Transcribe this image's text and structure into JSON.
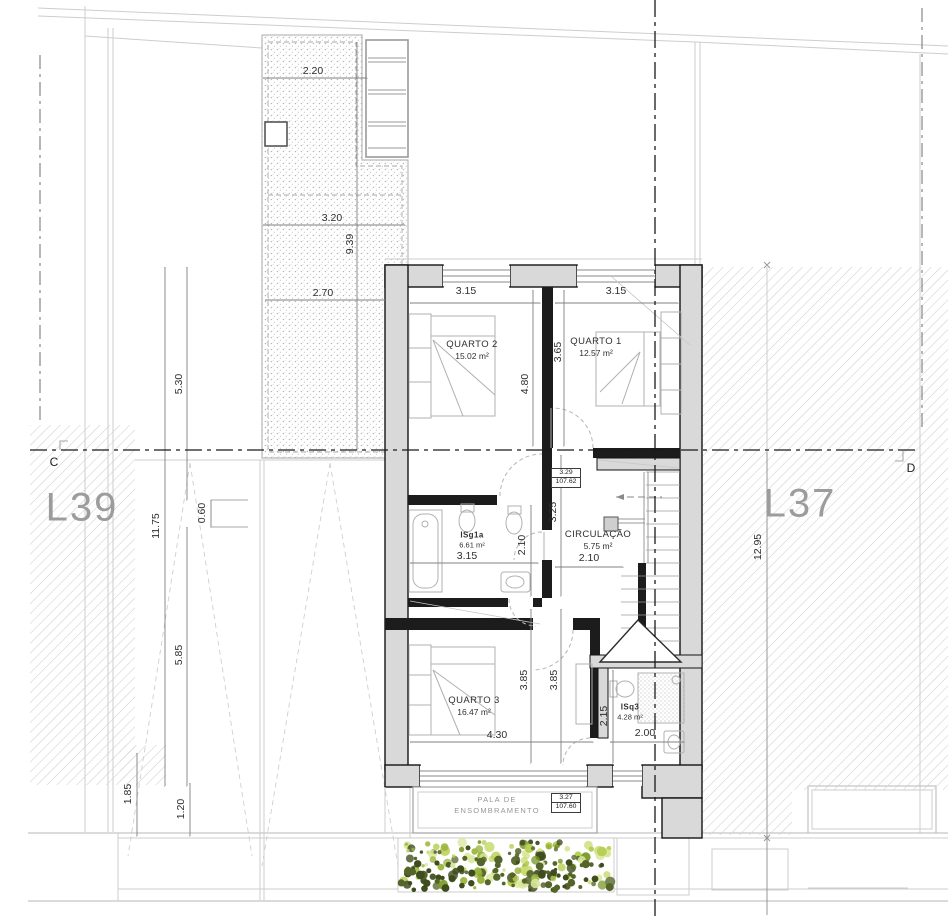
{
  "title": "Floor plan – upper level, lots L37/L39",
  "colors": {
    "wall_fill": "#d9d9d9",
    "wall_stroke": "#141414",
    "hatch_line": "#cfcfcf",
    "dim_text": "#2e2e2e",
    "lot_text": "#9c9c9c",
    "veg_greens": [
      "#b6cf53",
      "#c8dc72",
      "#9ab43a",
      "#7e9a2e",
      "#55652a",
      "#3f4d1e",
      "#d9e79a"
    ]
  },
  "lots": {
    "left": {
      "label": "L39"
    },
    "right": {
      "label": "L37"
    }
  },
  "section": {
    "left": {
      "label": "C"
    },
    "right": {
      "label": "D"
    }
  },
  "pala": {
    "line1": "PALA DE",
    "line2": "ENSOMBRAMENTO"
  },
  "rooms": [
    {
      "name": "QUARTO 2",
      "area": "15.02 m²",
      "x": 472,
      "y": 350,
      "small": false
    },
    {
      "name": "QUARTO 1",
      "area": "12.57 m²",
      "x": 596,
      "y": 347,
      "small": false
    },
    {
      "name": "ISg1a",
      "area": "6.61 m²",
      "x": 472,
      "y": 540,
      "small": true
    },
    {
      "name": "CIRCULAÇÃO",
      "area": "5.75 m²",
      "x": 598,
      "y": 540,
      "small": false
    },
    {
      "name": "QUARTO 3",
      "area": "16.47 m²",
      "x": 474,
      "y": 706,
      "small": false
    },
    {
      "name": "ISq3",
      "area": "4.28 m²",
      "x": 630,
      "y": 712,
      "small": true
    }
  ],
  "levels": [
    {
      "value": "3.29",
      "elevation": "107.62",
      "x": 551,
      "y": 468
    },
    {
      "value": "3.27",
      "elevation": "107.60",
      "x": 551,
      "y": 793
    }
  ],
  "dimensions": [
    {
      "text": "2.20",
      "x": 313,
      "y": 71,
      "rot": 0
    },
    {
      "text": "3.20",
      "x": 332,
      "y": 218,
      "rot": 0
    },
    {
      "text": "2.70",
      "x": 323,
      "y": 293,
      "rot": 0
    },
    {
      "text": "9.39",
      "x": 350,
      "y": 244,
      "rot": -90
    },
    {
      "text": "5.30",
      "x": 179,
      "y": 384,
      "rot": -90
    },
    {
      "text": "0.60",
      "x": 202,
      "y": 513,
      "rot": -90
    },
    {
      "text": "11.75",
      "x": 156,
      "y": 526,
      "rot": -90
    },
    {
      "text": "5.85",
      "x": 179,
      "y": 655,
      "rot": -90
    },
    {
      "text": "1.85",
      "x": 128,
      "y": 794,
      "rot": -90
    },
    {
      "text": "1.20",
      "x": 181,
      "y": 809,
      "rot": -90
    },
    {
      "text": "3.15",
      "x": 466,
      "y": 291,
      "rot": 0
    },
    {
      "text": "3.15",
      "x": 616,
      "y": 291,
      "rot": 0
    },
    {
      "text": "4.80",
      "x": 525,
      "y": 384,
      "rot": -90
    },
    {
      "text": "3.65",
      "x": 558,
      "y": 352,
      "rot": -90
    },
    {
      "text": "3.25",
      "x": 553,
      "y": 512,
      "rot": -90
    },
    {
      "text": "2.10",
      "x": 522,
      "y": 545,
      "rot": -90
    },
    {
      "text": "3.15",
      "x": 467,
      "y": 556,
      "rot": 0
    },
    {
      "text": "2.10",
      "x": 589,
      "y": 558,
      "rot": 0
    },
    {
      "text": "3.85",
      "x": 524,
      "y": 680,
      "rot": -90
    },
    {
      "text": "3.85",
      "x": 554,
      "y": 680,
      "rot": -90
    },
    {
      "text": "4.30",
      "x": 497,
      "y": 735,
      "rot": 0
    },
    {
      "text": "2.00",
      "x": 645,
      "y": 733,
      "rot": 0
    },
    {
      "text": "2.15",
      "x": 604,
      "y": 716,
      "rot": -90
    },
    {
      "text": "12.95",
      "x": 758,
      "y": 547,
      "rot": -90
    }
  ]
}
